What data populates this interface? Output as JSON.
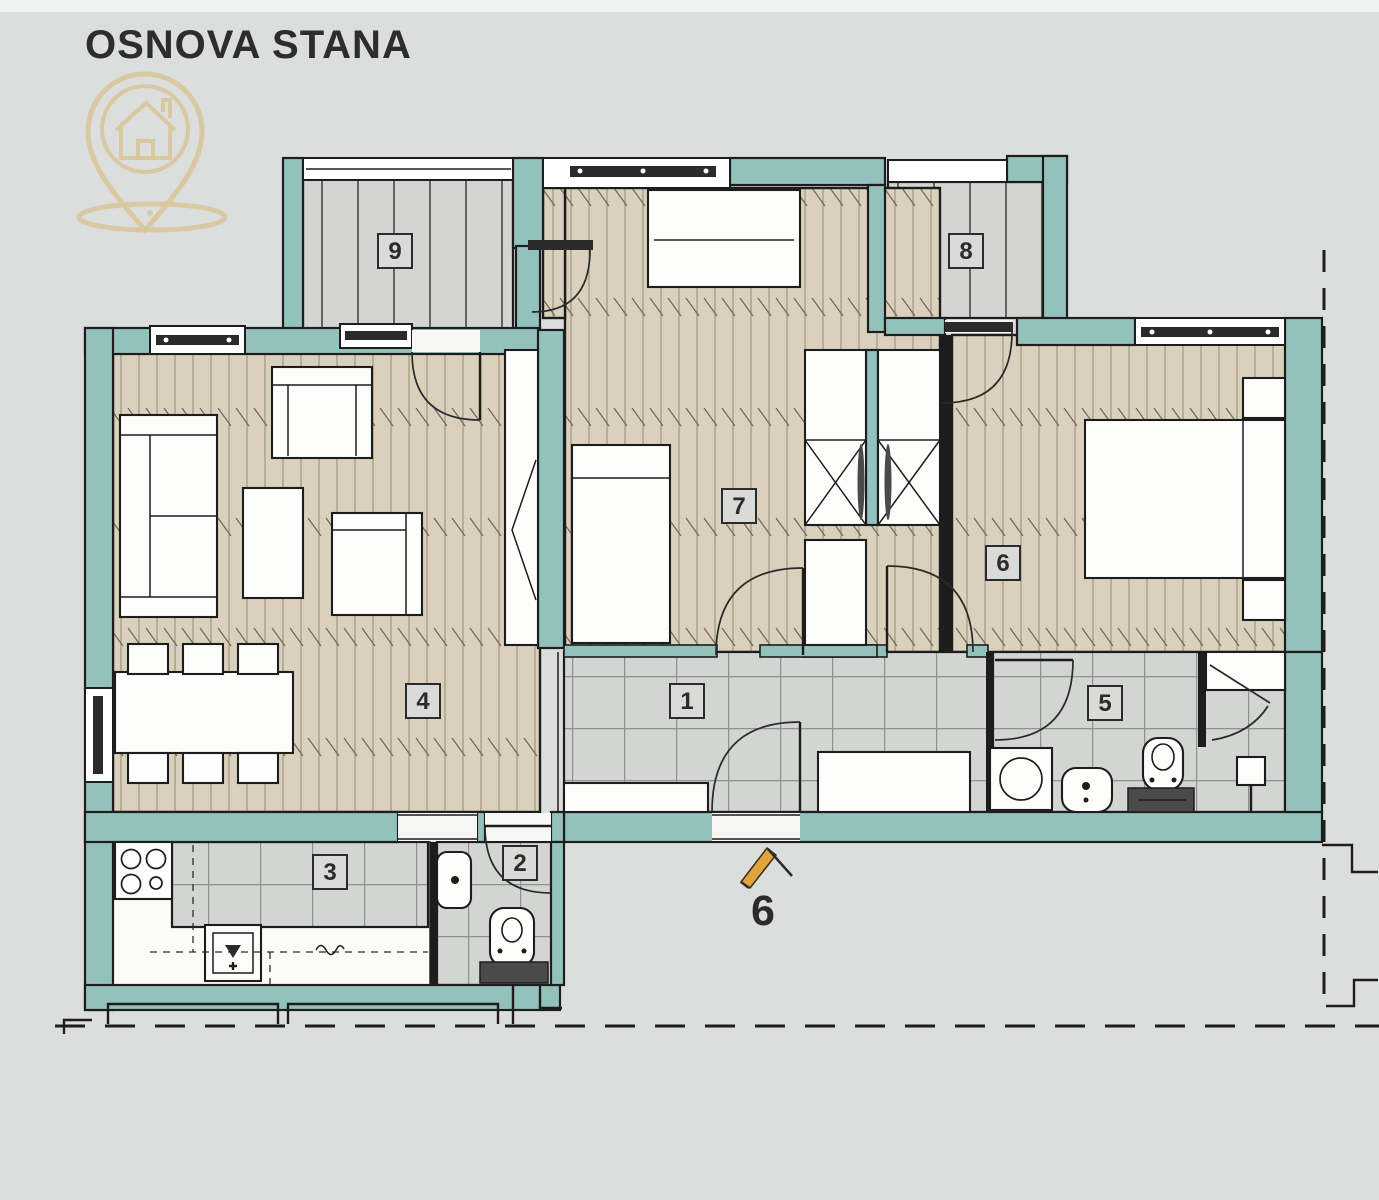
{
  "header": {
    "title": "OSNOVA STANA"
  },
  "logo": {
    "icon": "house-location-pin-icon",
    "color": "#d8c79b"
  },
  "floorplan": {
    "room_labels": [
      "1",
      "2",
      "3",
      "4",
      "5",
      "6",
      "7",
      "8",
      "9"
    ],
    "entrance": {
      "number": "6",
      "marker_icon": "entrance-arrow-icon",
      "marker_color": "#dfa43c"
    },
    "colors": {
      "background": "#dcdddd",
      "wall": "#93c2bd",
      "outline": "#1d1d1d",
      "wood_floor": "#d9d1bd",
      "tile_floor": "#d2d5d2",
      "balcony_floor": "#d4d4d2",
      "accent": "#dfa43c",
      "logo": "#d8c79b"
    }
  }
}
